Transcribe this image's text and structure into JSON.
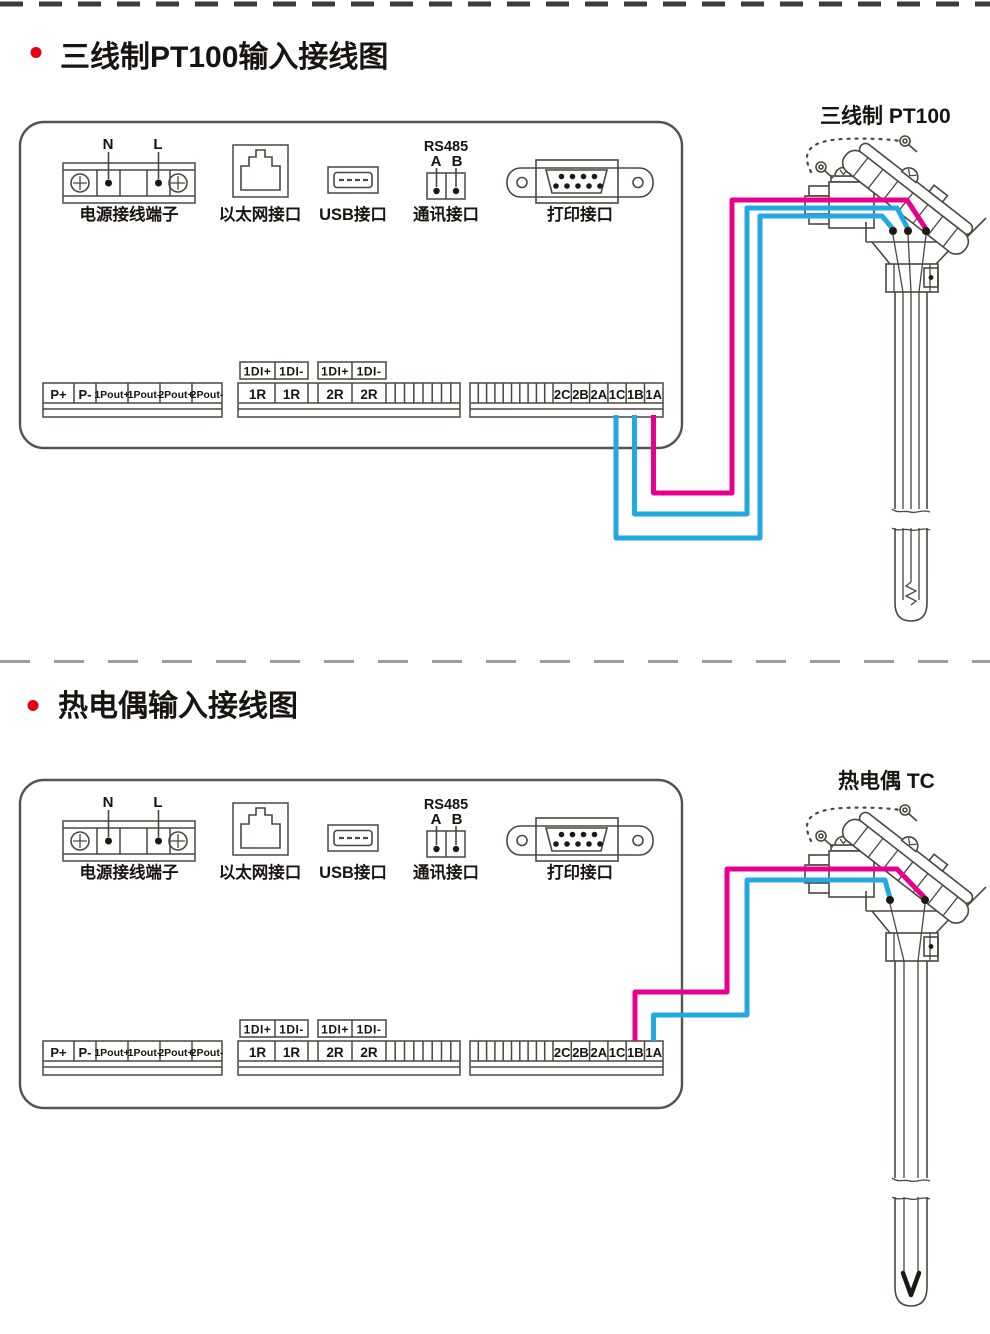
{
  "colors": {
    "wire_magenta": "#e8008c",
    "wire_cyan": "#22a8e2",
    "bullet_red": "#e60012",
    "line_art": "#4c463f"
  },
  "sections": [
    {
      "title": "三线制PT100输入接线图",
      "sensor_caption": "三线制 PT100",
      "panel": {
        "power": {
          "label": "电源接线端子",
          "terminal_n": "N",
          "terminal_l": "L"
        },
        "ethernet": {
          "label": "以太网接口"
        },
        "usb": {
          "label": "USB接口"
        },
        "comm": {
          "label": "通讯接口",
          "bus": "RS485",
          "pin_a": "A",
          "pin_b": "B"
        },
        "printer": {
          "label": "打印接口"
        },
        "analog_out": {
          "cells": [
            "P+",
            "P-",
            "1Pout+",
            "1Pout-",
            "2Pout+",
            "2Pout-"
          ]
        },
        "digital_in": {
          "cells": [
            "1DI+",
            "1DI-",
            "1DI+",
            "1DI-"
          ]
        },
        "relay": {
          "cells": [
            "1R",
            "1R",
            "2R",
            "2R"
          ]
        },
        "input": {
          "cells": [
            "2C",
            "2B",
            "2A",
            "1C",
            "1B",
            "1A"
          ]
        }
      },
      "wiring": {
        "wires": [
          {
            "terminal": "1A",
            "color": "#e8008c"
          },
          {
            "terminal": "1B",
            "color": "#22a8e2"
          },
          {
            "terminal": "1C",
            "color": "#22a8e2"
          }
        ]
      }
    },
    {
      "title": "热电偶输入接线图",
      "sensor_caption": "热电偶 TC",
      "panel": {
        "power": {
          "label": "电源接线端子",
          "terminal_n": "N",
          "terminal_l": "L"
        },
        "ethernet": {
          "label": "以太网接口"
        },
        "usb": {
          "label": "USB接口"
        },
        "comm": {
          "label": "通讯接口",
          "bus": "RS485",
          "pin_a": "A",
          "pin_b": "B"
        },
        "printer": {
          "label": "打印接口"
        },
        "analog_out": {
          "cells": [
            "P+",
            "P-",
            "1Pout+",
            "1Pout-",
            "2Pout+",
            "2Pout-"
          ]
        },
        "digital_in": {
          "cells": [
            "1DI+",
            "1DI-",
            "1DI+",
            "1DI-"
          ]
        },
        "relay": {
          "cells": [
            "1R",
            "1R",
            "2R",
            "2R"
          ]
        },
        "input": {
          "cells": [
            "2C",
            "2B",
            "2A",
            "1C",
            "1B",
            "1A"
          ]
        }
      },
      "wiring": {
        "wires": [
          {
            "terminal": "1B",
            "color": "#e8008c"
          },
          {
            "terminal": "1A",
            "color": "#22a8e2"
          }
        ]
      }
    }
  ]
}
